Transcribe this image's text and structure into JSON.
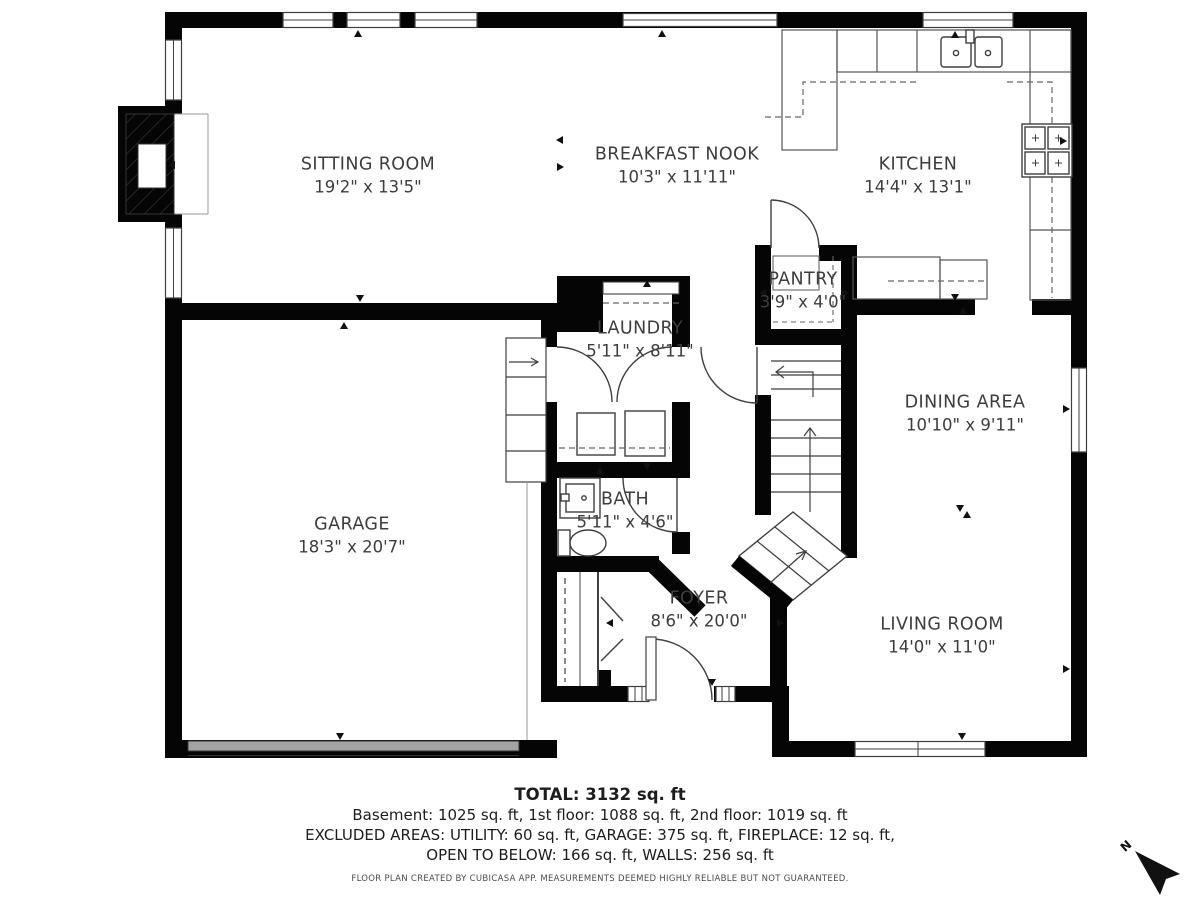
{
  "plan": {
    "rooms": [
      {
        "id": "sitting-room",
        "name": "SITTING ROOM",
        "dims": "19'2\" x 13'5\""
      },
      {
        "id": "breakfast-nook",
        "name": "BREAKFAST NOOK",
        "dims": "10'3\" x 11'11\""
      },
      {
        "id": "kitchen",
        "name": "KITCHEN",
        "dims": "14'4\" x 13'1\""
      },
      {
        "id": "pantry",
        "name": "PANTRY",
        "dims": "3'9\" x 4'0\""
      },
      {
        "id": "laundry",
        "name": "LAUNDRY",
        "dims": "5'11\" x 8'11\""
      },
      {
        "id": "dining-area",
        "name": "DINING AREA",
        "dims": "10'10\" x 9'11\""
      },
      {
        "id": "garage",
        "name": "GARAGE",
        "dims": "18'3\" x 20'7\""
      },
      {
        "id": "bath",
        "name": "BATH",
        "dims": "5'11\" x 4'6\""
      },
      {
        "id": "foyer",
        "name": "FOYER",
        "dims": "8'6\" x 20'0\""
      },
      {
        "id": "living-room",
        "name": "LIVING ROOM",
        "dims": "14'0\" x 11'0\""
      }
    ],
    "compass": {
      "label": "N"
    }
  },
  "summary": {
    "total": "TOTAL: 3132 sq. ft",
    "floors": "Basement: 1025 sq. ft, 1st floor: 1088 sq. ft, 2nd floor: 1019 sq. ft",
    "excluded_1": "EXCLUDED AREAS: UTILITY: 60 sq. ft, GARAGE: 375 sq. ft, FIREPLACE: 12 sq. ft,",
    "excluded_2": "OPEN TO BELOW: 166 sq. ft, WALLS: 256 sq. ft",
    "disclaimer": "FLOOR PLAN CREATED BY CUBICASA APP. MEASUREMENTS DEEMED HIGHLY RELIABLE BUT NOT GUARANTEED."
  },
  "colors": {
    "wall": "#000000",
    "line": "#3f3f3f",
    "garage_door": "#a3a3a3",
    "text": "#3d3d3d"
  }
}
